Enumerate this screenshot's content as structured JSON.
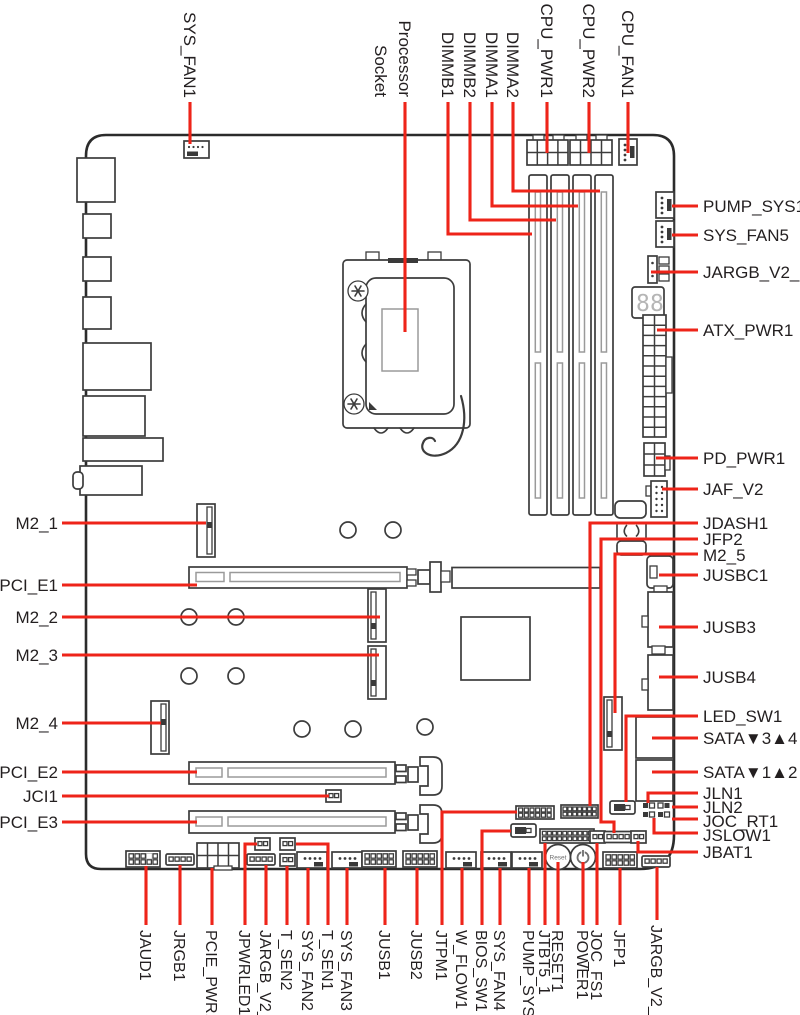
{
  "title": "Motherboard connectors overview diagram",
  "colors": {
    "leader_red": "#ee2419",
    "ink": "#231f20",
    "outline": "#2b2b2b"
  },
  "display": {
    "d1": "8",
    "d2": "8"
  },
  "buttons": {
    "reset": "Reset"
  },
  "labels": {
    "top": [
      "SYS_FAN1",
      "Processor",
      "Socket",
      "DIMMB1",
      "DIMMB2",
      "DIMMA1",
      "DIMMA2",
      "CPU_PWR1",
      "CPU_PWR2",
      "CPU_FAN1"
    ],
    "right": [
      "PUMP_SYS1",
      "SYS_FAN5",
      "JARGB_V2_3",
      "ATX_PWR1",
      "PD_PWR1",
      "JAF_V2",
      "JDASH1",
      "JFP2",
      "M2_5",
      "JUSBC1",
      "JUSB3",
      "JUSB4",
      "LED_SW1",
      "SATA▼3▲4",
      "SATA▼1▲2",
      "JLN1",
      "JLN2",
      "JOC_RT1",
      "JSLOW1",
      "JBAT1"
    ],
    "left": [
      "M2_1",
      "PCI_E1",
      "M2_2",
      "M2_3",
      "M2_4",
      "PCI_E2",
      "JCI1",
      "PCI_E3"
    ],
    "bottom": [
      "JAUD1",
      "JRGB1",
      "PCIE_PWR1",
      "JPWRLED1",
      "JARGB_V2_1",
      "T_SEN2",
      "SYS_FAN2",
      "T_SEN1",
      "SYS_FAN3",
      "JUSB1",
      "JUSB2",
      "JTPM1",
      "W_FLOW1",
      "BIOS_SW1",
      "SYS_FAN4",
      "PUMP_SYS2",
      "JTBT5_1",
      "RESET1",
      "POWER1",
      "JOC_FS1",
      "JFP1",
      "JARGB_V2_2"
    ]
  }
}
